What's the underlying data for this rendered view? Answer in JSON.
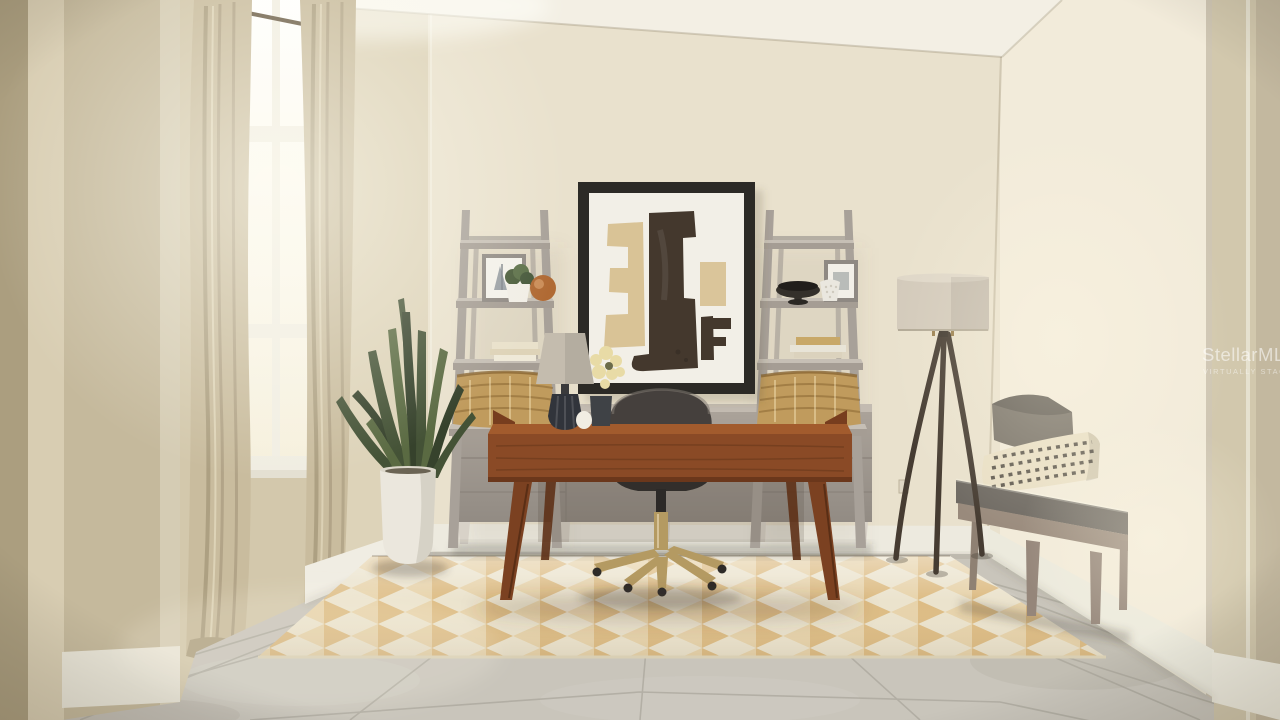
{
  "meta": {
    "kind": "virtually staged real-estate photograph",
    "room": "home office with desk, ladder shelves and window",
    "width_px": 1280,
    "height_px": 720
  },
  "watermark": {
    "brand": "StellarMLS",
    "tagline": "VIRTUALLY STAGED"
  },
  "scene": {
    "objects": [
      "window with beige curtains",
      "framed abstract artwork",
      "ladder bookshelf left",
      "ladder bookshelf right",
      "gray credenza",
      "walnut writing desk",
      "charcoal swivel desk chair with brass base",
      "table lamp with flowers",
      "snake plant in white planter",
      "tripod floor lamp",
      "upholstered bench with two pillows",
      "geometric diamond area rug",
      "gray stone tile floor"
    ]
  },
  "palette": {
    "back_wall": "#e9e1cd",
    "window_wall": "#d3c8ac",
    "corner_wall": "#ddd3b9",
    "fg_wall": "#c5b99c",
    "fg_wall_dark": "#ab9e7f",
    "fg_wall_light": "#d8cdb2",
    "right_wall": "#f2ebda",
    "door_strip": "#d2c8ad",
    "ceiling": "#f3efe4",
    "floor": "#c9c5bb",
    "grout": "#a7a398",
    "baseboard": "#edeadf",
    "rug_cream": "#ebe3cd",
    "rug_tan": "#dcb87c",
    "rug_tan2": "#e7d0a5",
    "curtain": "#c9bc9e",
    "curtain_dark": "#b0a385",
    "window_pane": "#fcfaf2",
    "window_frame": "#f1eee3",
    "credenza": "#aaa299",
    "credenza_top": "#c3bbb1",
    "shelf": "#a8a199",
    "shelf_top": "#c6bfb5",
    "basket": "#c09b5d",
    "basket_line": "#8a6733",
    "art_frame": "#2c2a26",
    "art_mat": "#f2efe7",
    "art_dark": "#44382d",
    "art_tan": "#d7c091",
    "desk": "#8a4a26",
    "desk_top": "#a25b2d",
    "desk_dark": "#6b371b",
    "chair": "#45403d",
    "chair_dark": "#322e2b",
    "gold": "#b49a62",
    "desk_lamp_shade": "#c4bcae",
    "desk_lamp_base": "#31343b",
    "floor_lamp_shade": "#d3cabb",
    "floor_lamp_leg": "#463c32",
    "plant": "#445236",
    "plant_dark": "#36422c",
    "plant_light": "#5a6a42",
    "planter": "#ebe7dd",
    "bench_wood": "#998a7c",
    "bench_cushion": "#6e6962",
    "pillow_gray": "#787268",
    "pillow_cream": "#e9dfc5",
    "pillow_stitch": "#3e3a33",
    "flower": "#e8dba6",
    "watermark_color": "rgba(255,255,255,0.55)"
  }
}
